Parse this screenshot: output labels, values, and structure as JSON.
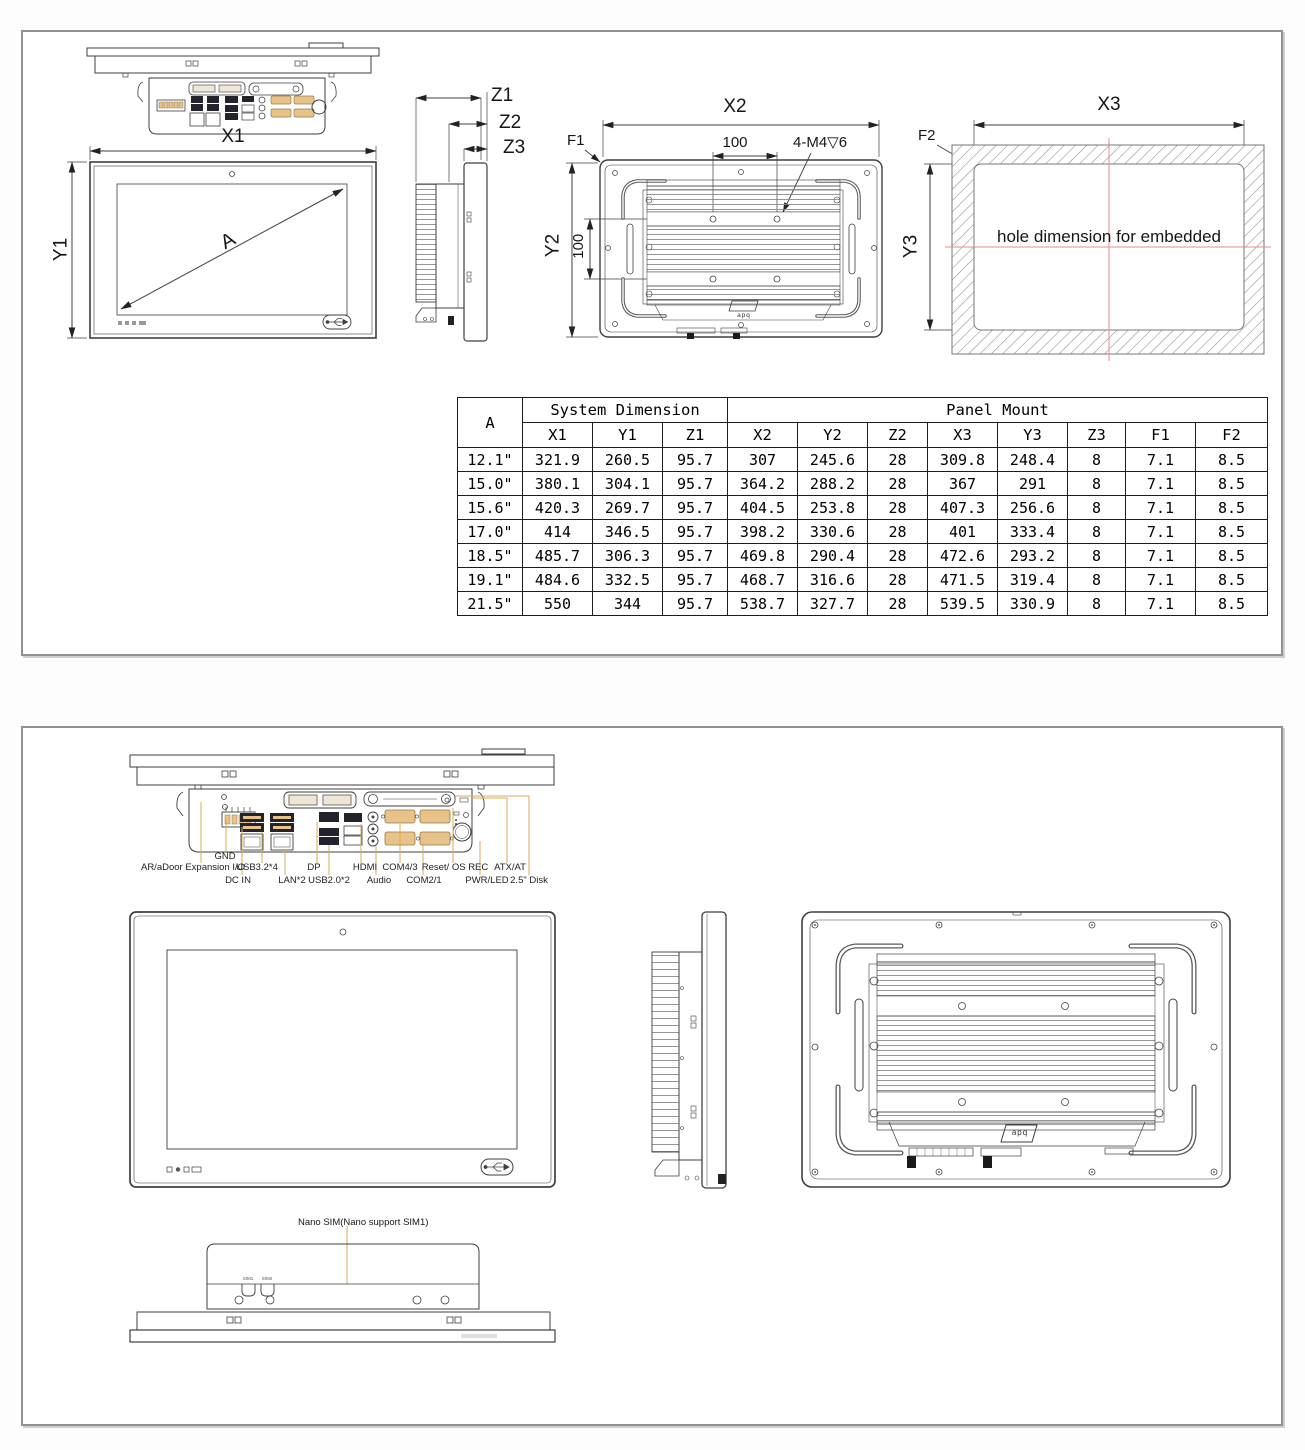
{
  "brand_logo": "apq",
  "sheet1": {
    "front_view": {
      "width_label": "X1",
      "height_label": "Y1",
      "diagonal_label": "A"
    },
    "side_view": {
      "depth_total_label": "Z1",
      "depth_mid_label": "Z2",
      "depth_panel_label": "Z3"
    },
    "rear_view": {
      "width_label": "X2",
      "height_label": "Y2",
      "vesa_width": "100",
      "vesa_height": "100",
      "screw_note": "4-M4▽6",
      "corner_note": "F1"
    },
    "cutout_view": {
      "width_label": "X3",
      "height_label": "Y3",
      "corner_note": "F2",
      "note": "hole dimension for embedded"
    },
    "table": {
      "size_header": "A",
      "system_header": "System Dimension",
      "panel_header": "Panel Mount",
      "columns": [
        "X1",
        "Y1",
        "Z1",
        "X2",
        "Y2",
        "Z2",
        "X3",
        "Y3",
        "Z3",
        "F1",
        "F2"
      ],
      "rows": [
        {
          "size": "12.1\"",
          "values": [
            "321.9",
            "260.5",
            "95.7",
            "307",
            "245.6",
            "28",
            "309.8",
            "248.4",
            "8",
            "7.1",
            "8.5"
          ]
        },
        {
          "size": "15.0\"",
          "values": [
            "380.1",
            "304.1",
            "95.7",
            "364.2",
            "288.2",
            "28",
            "367",
            "291",
            "8",
            "7.1",
            "8.5"
          ]
        },
        {
          "size": "15.6\"",
          "values": [
            "420.3",
            "269.7",
            "95.7",
            "404.5",
            "253.8",
            "28",
            "407.3",
            "256.6",
            "8",
            "7.1",
            "8.5"
          ]
        },
        {
          "size": "17.0\"",
          "values": [
            "414",
            "346.5",
            "95.7",
            "398.2",
            "330.6",
            "28",
            "401",
            "333.4",
            "8",
            "7.1",
            "8.5"
          ]
        },
        {
          "size": "18.5\"",
          "values": [
            "485.7",
            "306.3",
            "95.7",
            "469.8",
            "290.4",
            "28",
            "472.6",
            "293.2",
            "8",
            "7.1",
            "8.5"
          ]
        },
        {
          "size": "19.1\"",
          "values": [
            "484.6",
            "332.5",
            "95.7",
            "468.7",
            "316.6",
            "28",
            "471.5",
            "319.4",
            "8",
            "7.1",
            "8.5"
          ]
        },
        {
          "size": "21.5\"",
          "values": [
            "550",
            "344",
            "95.7",
            "538.7",
            "327.7",
            "28",
            "539.5",
            "330.9",
            "8",
            "7.1",
            "8.5"
          ]
        }
      ]
    }
  },
  "sheet2": {
    "io": {
      "gnd": "GND",
      "expansion": "AR/aDoor Expansion I/O",
      "usb32": "USB3.2*4",
      "dp": "DP",
      "hdmi": "HDMI",
      "com43": "COM4/3",
      "reset": "Reset/ OS REC",
      "atx": "ATX/AT",
      "dcin": "DC IN",
      "lan": "LAN*2",
      "usb20": "USB2.0*2",
      "audio": "Audio",
      "com21": "COM2/1",
      "pwr": "PWR/LED",
      "disk": "2.5\" Disk"
    },
    "nano_sim_note": "Nano SIM(Nano support SIM1)",
    "sim_slots": [
      "SIM1",
      "SIM2"
    ]
  },
  "colors": {
    "line": "#3f3f3f",
    "leader": "#dcaa55",
    "centerline": "#e98b8b",
    "port_dark": "#23232d",
    "port_tan": "#e7c289"
  }
}
